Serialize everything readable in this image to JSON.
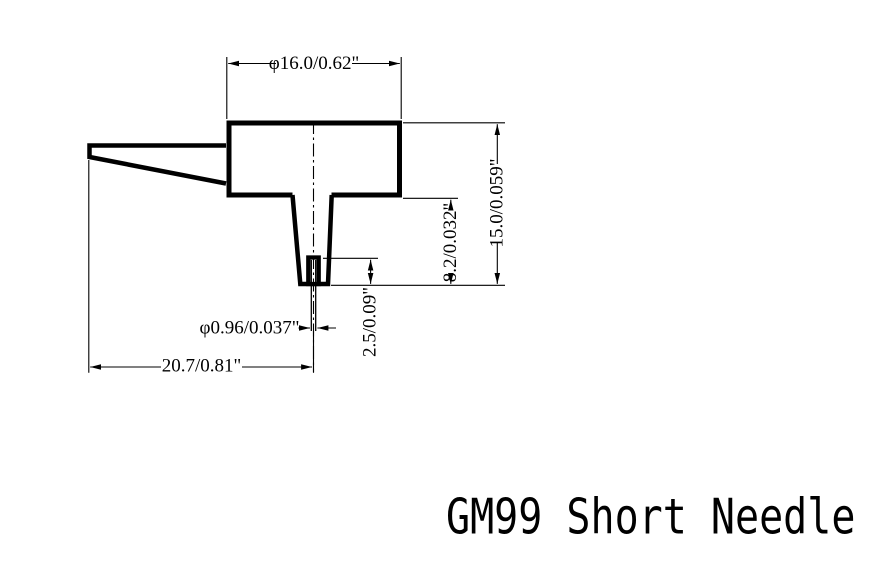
{
  "title": "GM99 Short Needle",
  "drawing": {
    "part_name": "GM99 Short Needle",
    "dim_head_diameter": "φ16.0/0.62\"",
    "dim_total_height": "15.0/0.059\"",
    "dim_stem_height": "8.2/0.032\"",
    "dim_tip_height": "2.5/0.09\"",
    "dim_needle_diameter": "φ0.96/0.037\"",
    "dim_total_length": "20.7/0.81\""
  },
  "colors": {
    "line": "#000000",
    "background": "#ffffff"
  }
}
